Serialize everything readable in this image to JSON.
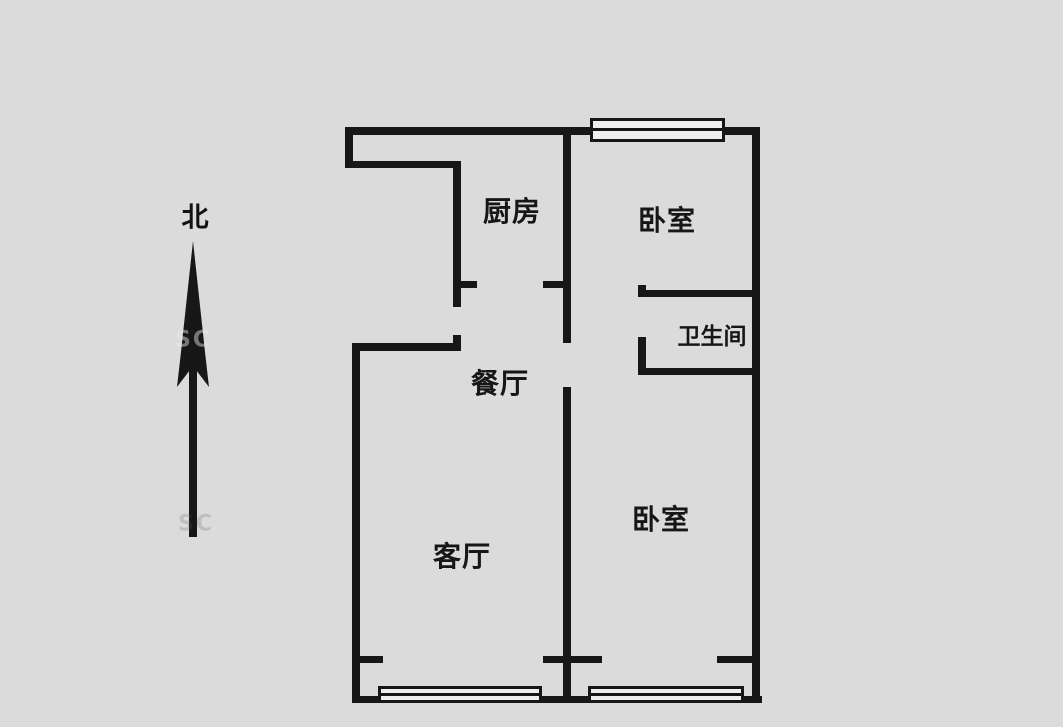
{
  "compass": {
    "label": "北"
  },
  "rooms": {
    "kitchen": {
      "label": "厨房"
    },
    "bedroom_top": {
      "label": "卧室"
    },
    "bathroom": {
      "label": "卫生间"
    },
    "dining": {
      "label": "餐厅"
    },
    "living": {
      "label": "客厅"
    },
    "bedroom_bottom": {
      "label": "卧室"
    }
  },
  "watermarks": [
    {
      "text": "SC"
    },
    {
      "text": "SC"
    }
  ],
  "colors": {
    "background": "#dbdbdb",
    "wall": "#171717",
    "window_fill": "#efefef"
  }
}
